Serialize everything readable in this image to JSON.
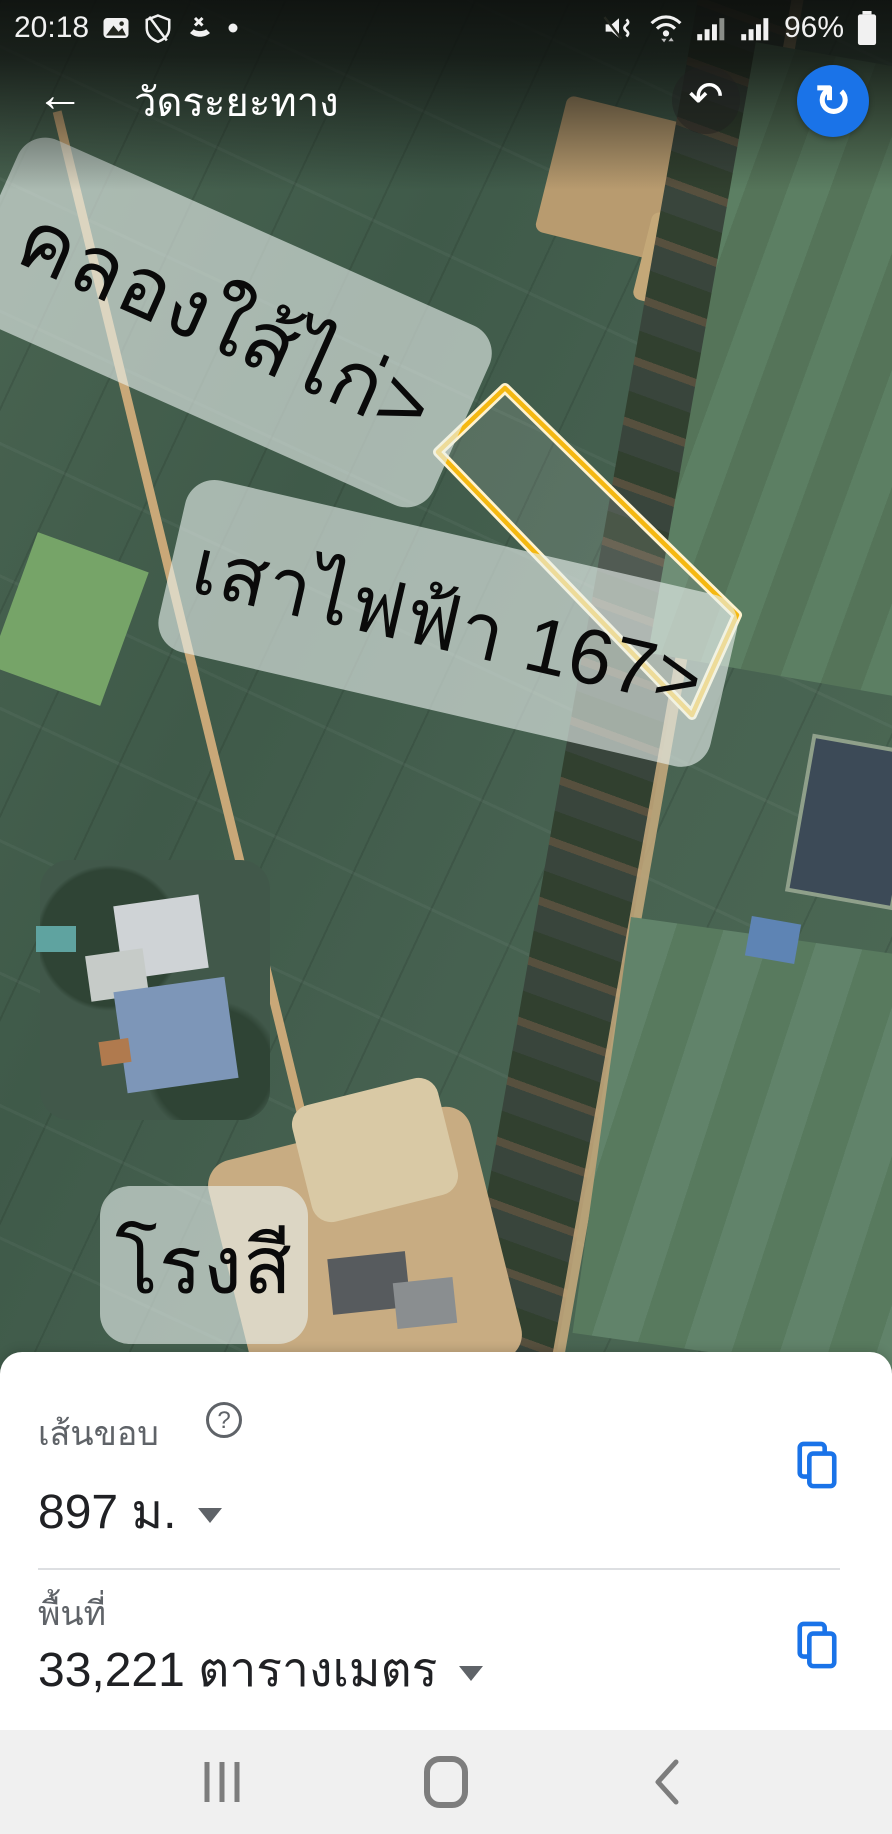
{
  "status_bar": {
    "time": "20:18",
    "battery_percent": "96%",
    "left_icons": [
      "image-icon",
      "shield-off-icon",
      "missed-call-icon",
      "notification-dot"
    ],
    "right_icons": [
      "mute-vibrate-icon",
      "wifi-icon",
      "signal-bars-icon",
      "signal-bars-icon",
      "battery-icon"
    ]
  },
  "header": {
    "title": "วัดระยะทาง",
    "back_glyph": "←",
    "undo_glyph": "↶",
    "refresh_glyph": "↻",
    "accent_color": "#1A73E8"
  },
  "map": {
    "type": "satellite",
    "annotations": [
      {
        "text": "คลองใส้ไก่>",
        "rotation_deg": 24
      },
      {
        "text": "เสาไฟฟ้า 167>",
        "rotation_deg": 13
      },
      {
        "text": "โรงสี",
        "rotation_deg": 0
      }
    ],
    "measurement_polygon": {
      "points": "505,388 438,452 692,715 737,615",
      "stroke_color": "#F5B811",
      "glow_color": "#FFF3CF"
    }
  },
  "bottom_sheet": {
    "perimeter_label": "เส้นขอบ",
    "help_glyph": "?",
    "perimeter_value": "897 ม.",
    "area_label": "พื้นที่",
    "area_value": "33,221 ตารางเมตร",
    "copy_icon_color": "#1A73E8"
  },
  "nav_bar": {
    "icons": [
      "recents-icon",
      "home-icon",
      "back-icon"
    ]
  }
}
